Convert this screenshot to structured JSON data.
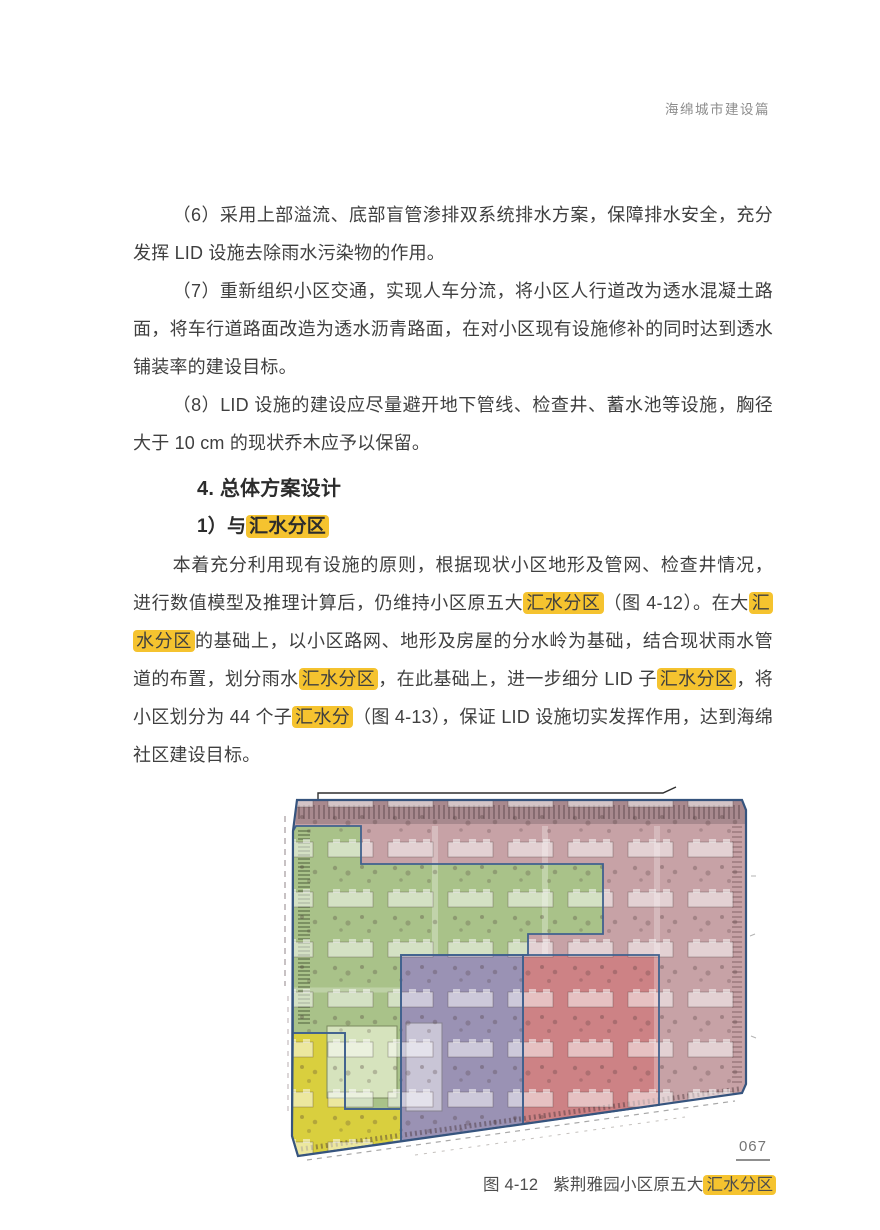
{
  "page": {
    "header_title": "海绵城市建设篇",
    "page_number": "067"
  },
  "colors": {
    "highlight": "#F5C32F",
    "zone_pink": "#c7a2a6",
    "zone_green": "#a9c289",
    "zone_purple": "#9a92b4",
    "zone_red": "#cd8285",
    "zone_yellow": "#d9cf3e",
    "zone_border": "#40618e",
    "site_border": "#36547e",
    "top_band": "#a8898e"
  },
  "content": {
    "para6": "（6）采用上部溢流、底部盲管渗排双系统排水方案，保障排水安全，充分发挥 LID 设施去除雨水污染物的作用。",
    "para7": "（7）重新组织小区交通，实现人车分流，将小区人行道改为透水混凝土路面，将车行道路面改造为透水沥青路面，在对小区现有设施修补的同时达到透水铺装率的建设目标。",
    "para8": "（8）LID 设施的建设应尽量避开地下管线、检查井、蓄水池等设施，胸径大于 10 cm 的现状乔木应予以保留。",
    "section_heading": "4. 总体方案设计",
    "sub_heading_segments": [
      {
        "t": "1）与",
        "h": false
      },
      {
        "t": "汇水分区",
        "h": true
      }
    ],
    "main_para_segments": [
      {
        "t": "本着充分利用现有设施的原则，根据现状小区地形及管网、检查井情况，进行数值模型及推理计算后，仍维持小区原五大",
        "h": false
      },
      {
        "t": "汇水分区",
        "h": true
      },
      {
        "t": "（图 4-12）。在大",
        "h": false
      },
      {
        "t": "汇水分区",
        "h": true
      },
      {
        "t": "的基础上，以小区路网、地形及房屋的分水岭为基础，结合现状雨水管道的布置，划分雨水",
        "h": false
      },
      {
        "t": "汇水分区",
        "h": true
      },
      {
        "t": "，在此基础上，进一步细分 LID 子",
        "h": false
      },
      {
        "t": "汇水分区",
        "h": true
      },
      {
        "t": "，将小区划分为 44 个子",
        "h": false
      },
      {
        "t": "汇水分",
        "h": true
      },
      {
        "t": "（图 4-13），保证 LID 设施切实发挥作用，达到海绵社区建设目标。",
        "h": false
      }
    ]
  },
  "figure": {
    "caption_label": "图 4-12",
    "caption_text": "紫荆雅园小区原五大",
    "caption_highlight": "汇水分区",
    "zone_count": 5,
    "zones": [
      "pink",
      "green",
      "purple",
      "red",
      "yellow"
    ]
  }
}
